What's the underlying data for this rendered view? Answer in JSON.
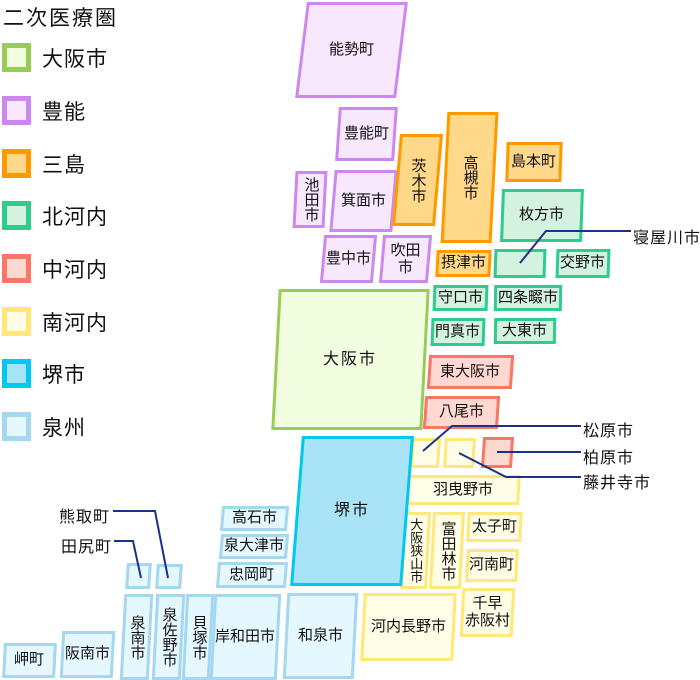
{
  "legend": {
    "title": "二次医療圏",
    "items": [
      {
        "id": "osaka",
        "label": "大阪市"
      },
      {
        "id": "toyono",
        "label": "豊能"
      },
      {
        "id": "mishima",
        "label": "三島"
      },
      {
        "id": "kita",
        "label": "北河内"
      },
      {
        "id": "naka",
        "label": "中河内"
      },
      {
        "id": "minami",
        "label": "南河内"
      },
      {
        "id": "sakai",
        "label": "堺市"
      },
      {
        "id": "senshu",
        "label": "泉州"
      }
    ]
  },
  "colors": {
    "osaka": {
      "border": "#99cc55",
      "fill": "#f1ffe0"
    },
    "toyono": {
      "border": "#cc88ee",
      "fill": "#f7e8fe"
    },
    "mishima": {
      "border": "#ff9900",
      "fill": "#ffd88a"
    },
    "kita": {
      "border": "#2fcc8f",
      "fill": "#d4f2e0"
    },
    "naka": {
      "border": "#f87766",
      "fill": "#ffd8d1"
    },
    "minami": {
      "border": "#ffe878",
      "fill": "#fffde6"
    },
    "sakai": {
      "border": "#00c8f0",
      "fill": "#a9e3f8"
    },
    "senshu": {
      "border": "#a6d7f1",
      "fill": "#e5f7ff"
    },
    "callout_line": "#1a3388",
    "text": "#111111"
  },
  "map": {
    "boxes": {
      "nose": "能勢町",
      "toyono_cho": "豊能町",
      "ikeda": "池田市",
      "minoh": "箕面市",
      "toyonaka": "豊中市",
      "suita": "吹田市",
      "ibaraki": "茨木市",
      "takatsuki": "高槻市",
      "shimamoto": "島本町",
      "settsu": "摂津市",
      "hirakata": "枚方市",
      "katano": "交野市",
      "moriguchi": "守口市",
      "shijonawate": "四条畷市",
      "kadoma": "門真市",
      "daito": "大東市",
      "osaka_city": "大阪市",
      "higashiosaka": "東大阪市",
      "yao": "八尾市",
      "habikino": "羽曳野市",
      "osakasayama": "大阪狭山市",
      "tondabayashi": "富田林市",
      "taishi": "太子町",
      "kanan": "河南町",
      "chihaya": "千早\n赤阪村",
      "kawachinagano": "河内長野市",
      "sakai_city": "堺市",
      "takaishi": "高石市",
      "izumiotsu": "泉大津市",
      "tadaoka": "忠岡町",
      "sennan": "泉南市",
      "izumisano": "泉佐野市",
      "kaizuka": "貝塚市",
      "kishiwada": "岸和田市",
      "izumi": "和泉市",
      "hannan": "阪南市",
      "misaki": "岬町"
    },
    "callouts": {
      "neyagawa": "寝屋川市",
      "matsubara": "松原市",
      "kashiwara": "柏原市",
      "fujiidera": "藤井寺市",
      "kumatori": "熊取町",
      "tajiri": "田尻町"
    }
  }
}
